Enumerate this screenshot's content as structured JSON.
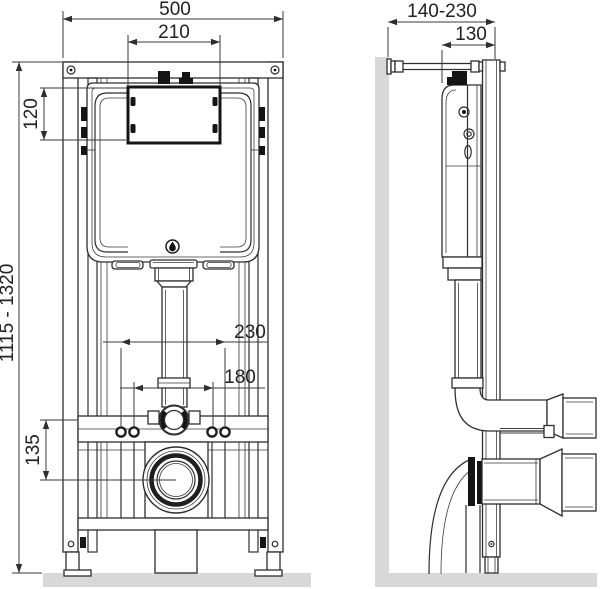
{
  "drawing": {
    "type": "technical-installation-drawing",
    "subject": "concealed-cistern-wc-installation-frame",
    "front_view": {
      "dim_overall_width": "500",
      "dim_service_opening_width": "210",
      "dim_service_opening_height": "120",
      "dim_frame_height_range": "1115 - 1320",
      "dim_bolt_spacing_outer": "230",
      "dim_bolt_spacing_inner": "180",
      "dim_flush_to_drain_offset": "135"
    },
    "side_view": {
      "dim_wall_offset_range": "140-230",
      "dim_depth_to_cistern": "130"
    },
    "icons": {
      "flush_emblem": "water-drop"
    },
    "colors": {
      "line": "#2e2e2e",
      "dimension_line": "#3a3a3a",
      "wall_floor_fill": "#d8d8d8",
      "background": "#ffffff"
    }
  }
}
